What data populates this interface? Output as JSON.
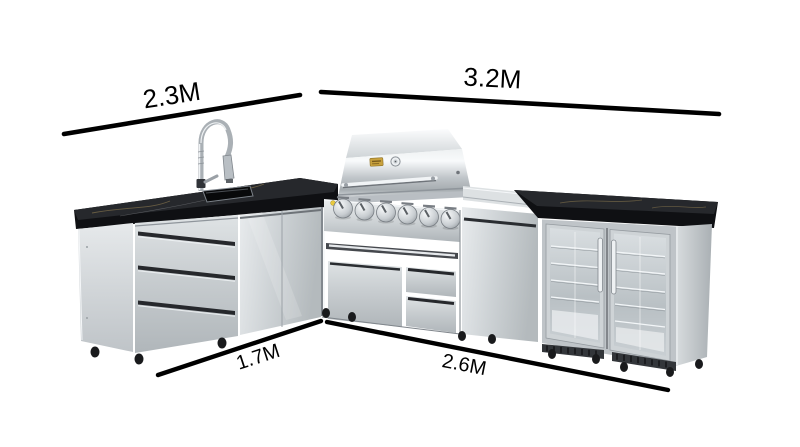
{
  "page": {
    "background_color": "#ffffff"
  },
  "dimension_annotations": {
    "line_color": "#000000",
    "labels": {
      "top_left": "2.3M",
      "top_right": "3.2M",
      "bottom_left": "1.7M",
      "bottom_right": "2.6M"
    }
  },
  "product_illustration": {
    "type": "l-shaped-stainless-outdoor-kitchen",
    "modules": [
      "sink-cabinet",
      "corner-cabinet",
      "gas-grill",
      "door-cabinet",
      "double-glass-door-fridge"
    ],
    "colors": {
      "stainless_light": "#e9ecee",
      "stainless_mid": "#c6cbce",
      "stainless_dark": "#9aa0a5",
      "countertop_black": "#141518",
      "marble_vein_gold": "#8a784f",
      "glass_gray": "#c3c9cd",
      "badge_gold": "#c9a23e",
      "igniter_yellow": "#e8c93e",
      "foot_black": "#1a1b1d"
    }
  }
}
